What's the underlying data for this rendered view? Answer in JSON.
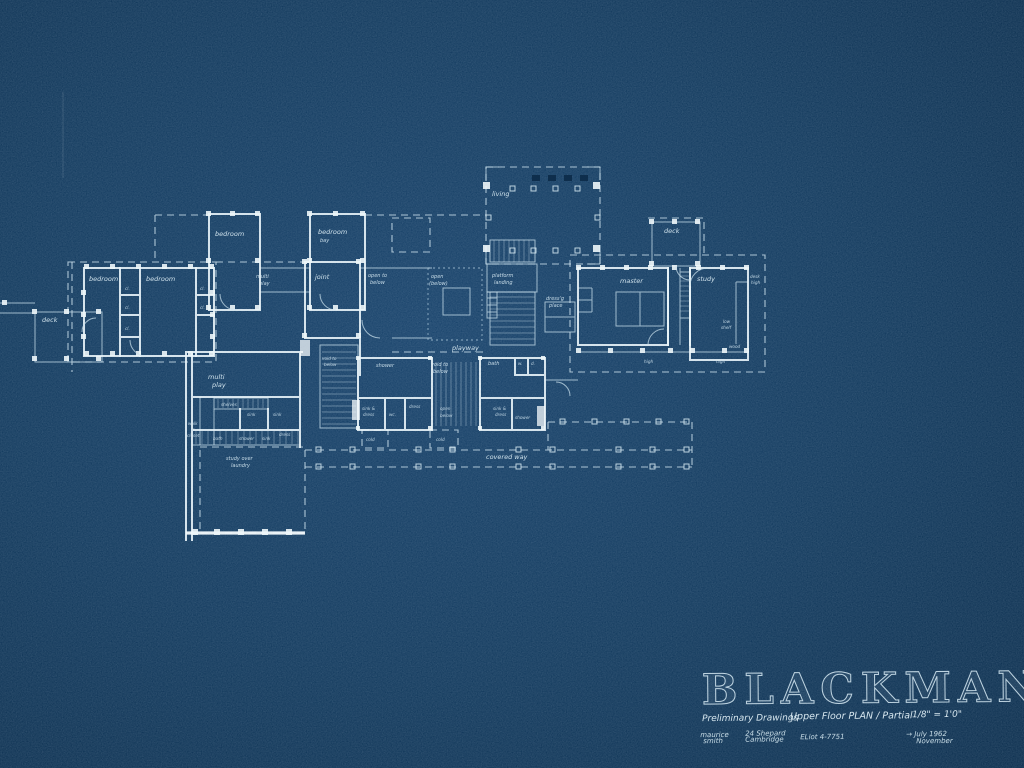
{
  "colors": {
    "background": "#123a5e",
    "ink": "#dcecf4",
    "ink_bright": "#f2f9fc"
  },
  "title_block": {
    "name": "BLACKMAN",
    "drawing_set": "Preliminary Drawings",
    "sheet_title": "Upper Floor PLAN / Partial",
    "scale": "1/8\" = 1'0\"",
    "architect_first": "maurice",
    "architect_last": "smith",
    "address_street": "24 Shepard",
    "address_city": "Cambridge",
    "phone": "ELiot 4-7751",
    "date_primary": "→ July 1962",
    "date_secondary": "November"
  },
  "plan": {
    "labels": [
      {
        "text": "living"
      },
      {
        "text": "deck"
      },
      {
        "text": "bedroom"
      },
      {
        "text": "bedroom"
      },
      {
        "text": "cl."
      },
      {
        "text": "cl."
      },
      {
        "text": "cl."
      },
      {
        "text": "cl."
      },
      {
        "text": "cl."
      },
      {
        "text": "bedroom"
      },
      {
        "text": "bedroom"
      },
      {
        "text": "bay"
      },
      {
        "text": "multi"
      },
      {
        "text": "play"
      },
      {
        "text": "joint"
      },
      {
        "text": "open to"
      },
      {
        "text": "below"
      },
      {
        "text": "open"
      },
      {
        "text": "(below)"
      },
      {
        "text": "platform"
      },
      {
        "text": "landing"
      },
      {
        "text": "dress'g"
      },
      {
        "text": "place"
      },
      {
        "text": "master"
      },
      {
        "text": "study"
      },
      {
        "text": "deck"
      },
      {
        "text": "desk"
      },
      {
        "text": "high"
      },
      {
        "text": "low"
      },
      {
        "text": "shelf"
      },
      {
        "text": "wood"
      },
      {
        "text": "high"
      },
      {
        "text": "high"
      },
      {
        "text": "playway"
      },
      {
        "text": "shower"
      },
      {
        "text": "void to"
      },
      {
        "text": "below"
      },
      {
        "text": "bath"
      },
      {
        "text": "w."
      },
      {
        "text": "d."
      },
      {
        "text": "sink &"
      },
      {
        "text": "dress"
      },
      {
        "text": "wc."
      },
      {
        "text": "dress"
      },
      {
        "text": "open"
      },
      {
        "text": "below"
      },
      {
        "text": "sink &"
      },
      {
        "text": "dress"
      },
      {
        "text": "shower"
      },
      {
        "text": "cold"
      },
      {
        "text": "cold"
      },
      {
        "text": "covered way"
      },
      {
        "text": "multi"
      },
      {
        "text": "play"
      },
      {
        "text": "shelves"
      },
      {
        "text": "sink"
      },
      {
        "text": "sink"
      },
      {
        "text": "bath"
      },
      {
        "text": "shower"
      },
      {
        "text": "sink"
      },
      {
        "text": "dress"
      },
      {
        "text": "walk"
      },
      {
        "text": "in"
      },
      {
        "text": "closet"
      },
      {
        "text": "study over"
      },
      {
        "text": "laundry"
      },
      {
        "text": "void to"
      },
      {
        "text": "below"
      }
    ]
  }
}
